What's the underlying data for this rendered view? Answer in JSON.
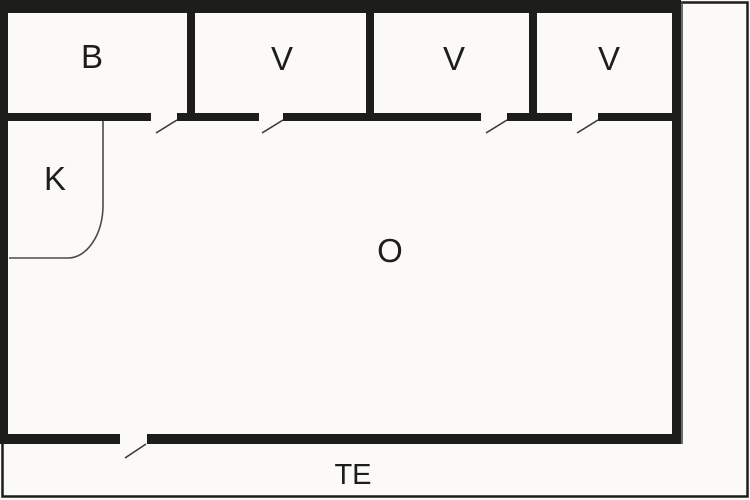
{
  "floor_plan": {
    "rooms": {
      "b": {
        "label": "B"
      },
      "v1": {
        "label": "V"
      },
      "v2": {
        "label": "V"
      },
      "v3": {
        "label": "V"
      },
      "k": {
        "label": "K"
      },
      "o": {
        "label": "O"
      },
      "terrace": {
        "label": "TE"
      }
    },
    "counts": {
      "door_openings_top_row": 4,
      "entrance_doors_bottom": 1
    },
    "colors": {
      "wall": "#1d1d1b",
      "thin_line": "#4a4a48",
      "background": "#fbfaf8",
      "text": "#1d1d1b"
    }
  }
}
